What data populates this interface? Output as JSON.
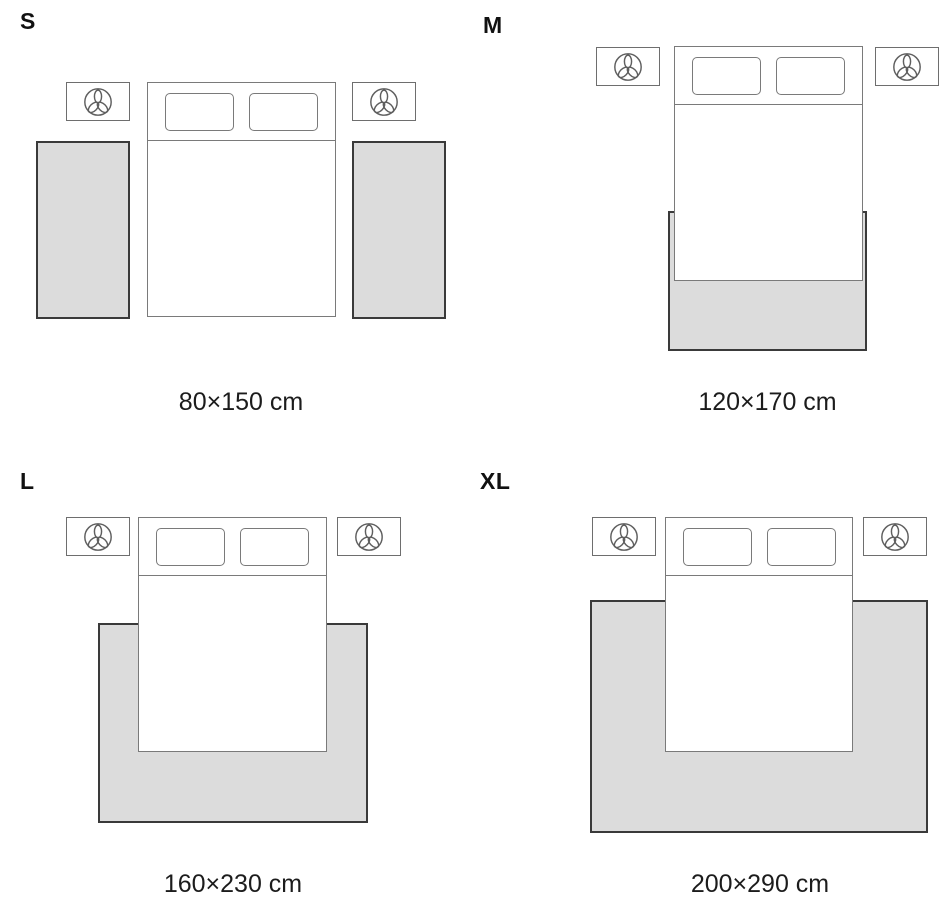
{
  "colors": {
    "background": "#ffffff",
    "rug_fill": "#dcdcdc",
    "rug_border": "#3a3a3a",
    "furniture_border": "#7a7a7a",
    "label_text": "#111111",
    "caption_text": "#1c1c1c"
  },
  "icons": {
    "lamp": "trefoil-lamp-icon"
  },
  "panels": {
    "s": {
      "label": "S",
      "size": "80×150 cm"
    },
    "m": {
      "label": "M",
      "size": "120×170 cm"
    },
    "l": {
      "label": "L",
      "size": "160×230 cm"
    },
    "xl": {
      "label": "XL",
      "size": "200×290 cm"
    }
  }
}
